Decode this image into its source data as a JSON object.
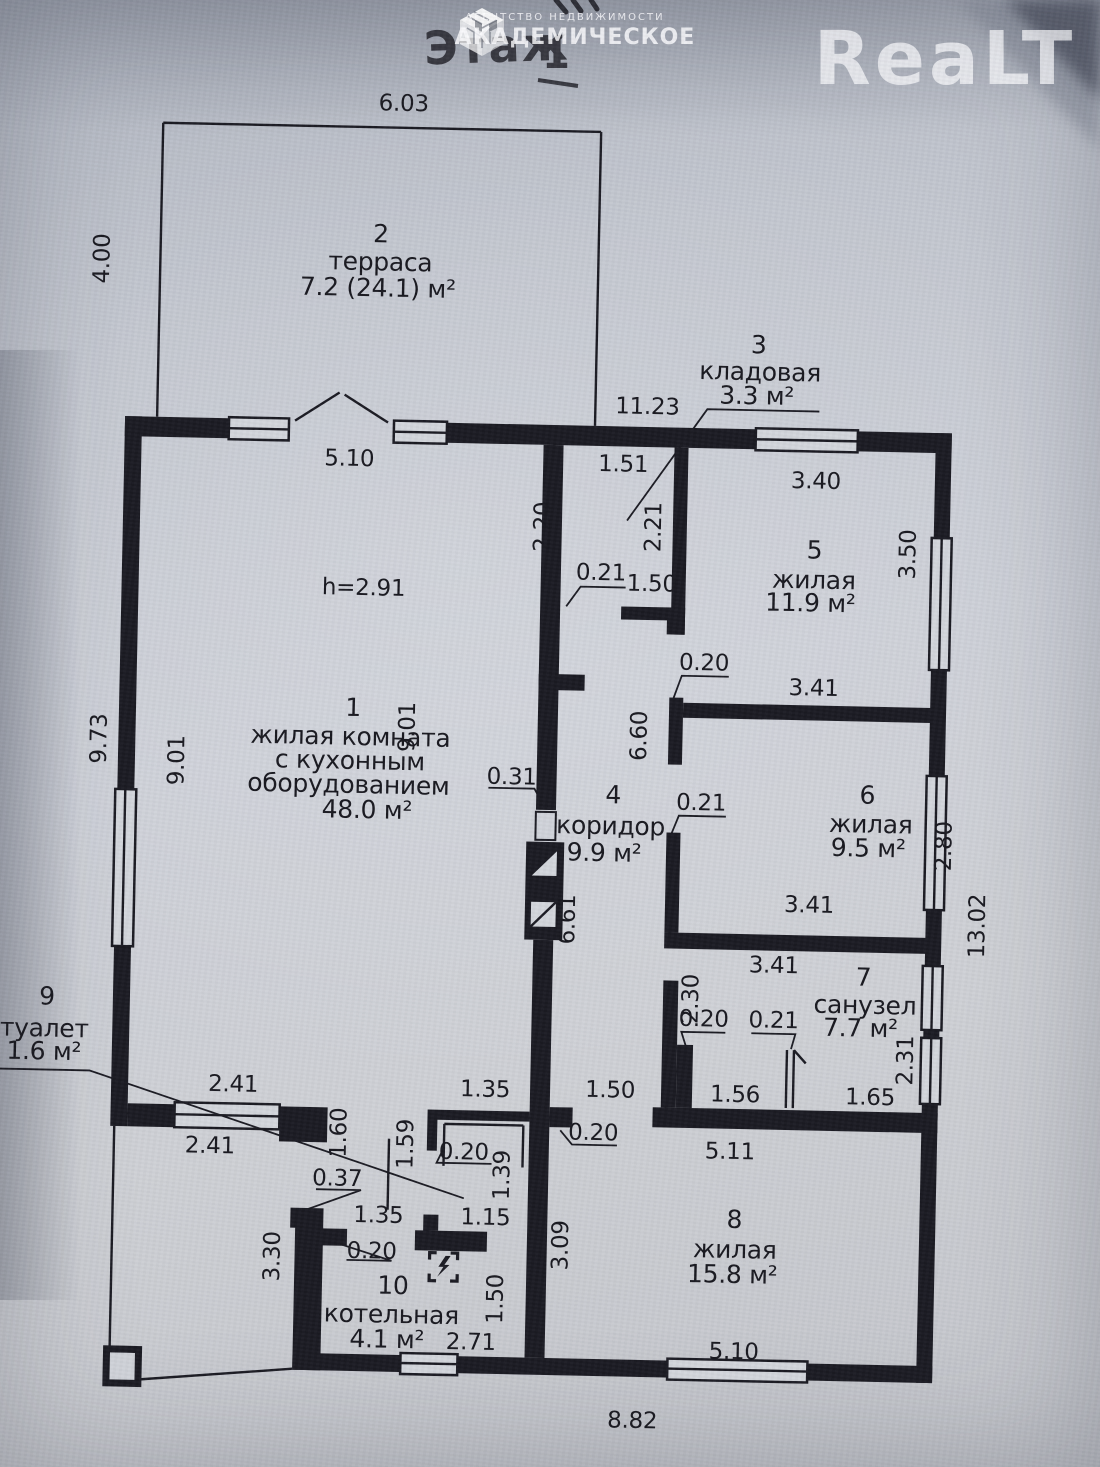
{
  "branding": {
    "realt_logo": "ReaLT",
    "agency_tagline": "АГЕНТСТВО НЕДВИЖИМОСТИ",
    "agency_name": "АКАДЕМИЧЕСКОЕ"
  },
  "title": {
    "floor_word": "Этаж",
    "floor_number": "1"
  },
  "ceiling_height": "h=2.91",
  "rooms": {
    "r1": {
      "num": "1",
      "line1": "жилая комната",
      "line2": "с кухонным",
      "line3": "оборудованием",
      "area": "48.0 м²"
    },
    "r2": {
      "num": "2",
      "name": "терраса",
      "area": "7.2 (24.1) м²"
    },
    "r3": {
      "num": "3",
      "name": "кладовая",
      "area": "3.3 м²"
    },
    "r4": {
      "num": "4",
      "name": "коридор",
      "area": "9.9 м²"
    },
    "r5": {
      "num": "5",
      "name": "жилая",
      "area": "11.9 м²"
    },
    "r6": {
      "num": "6",
      "name": "жилая",
      "area": "9.5 м²"
    },
    "r7": {
      "num": "7",
      "name": "санузел",
      "area": "7.7 м²"
    },
    "r8": {
      "num": "8",
      "name": "жилая",
      "area": "15.8 м²"
    },
    "r9": {
      "num": "9",
      "name": "туалет",
      "area": "1.6 м²"
    },
    "r10": {
      "num": "10",
      "name": "котельная",
      "area": "4.1 м²"
    }
  },
  "dims": {
    "terrace_width": "6.03",
    "terrace_depth": "4.00",
    "house_width_top": "11.23",
    "room1_width": "5.10",
    "pantry_width": "1.51",
    "room5_width": "3.40",
    "pantry_height_left": "2.20",
    "pantry_height_right": "2.21",
    "room5_height": "3.50",
    "pantry_wall": "0.21",
    "pantry_door": "1.50",
    "wall_56": "0.20",
    "room6_width_top": "3.41",
    "hall_upper": "6.60",
    "left_outer": "9.73",
    "left_inner": "9.01",
    "partition_height": "9.01",
    "partition_wall": "0.31",
    "room6_wall": "0.21",
    "room6_height": "2.80",
    "hall_length": "6.61",
    "room6_width_bottom": "3.41",
    "house_height_right": "13.02",
    "bath_width": "3.41",
    "bath_height_left": "2.30",
    "bath_pier1": "0.20",
    "bath_pier2": "0.21",
    "bath_height_right": "2.31",
    "bath_niche1": "1.56",
    "bath_niche2": "1.65",
    "wc_top": "2.41",
    "wc_bottom": "2.41",
    "porch_opening": "1.60",
    "room8_door": "1.50",
    "room8_width_top": "5.11",
    "wc_width": "1.35",
    "wc2_left": "1.59",
    "wc2_wall": "0.20",
    "wc2_right": "1.39",
    "room8_wall": "0.20",
    "boiler_pier": "0.37",
    "boiler_door1": "1.35",
    "boiler_door2": "1.15",
    "room8_height": "3.09",
    "boiler_wall": "0.20",
    "porch_height": "3.30",
    "boiler_height": "1.50",
    "boiler_width": "2.71",
    "room8_width_bottom": "5.10",
    "house_width_bottom": "8.82"
  }
}
